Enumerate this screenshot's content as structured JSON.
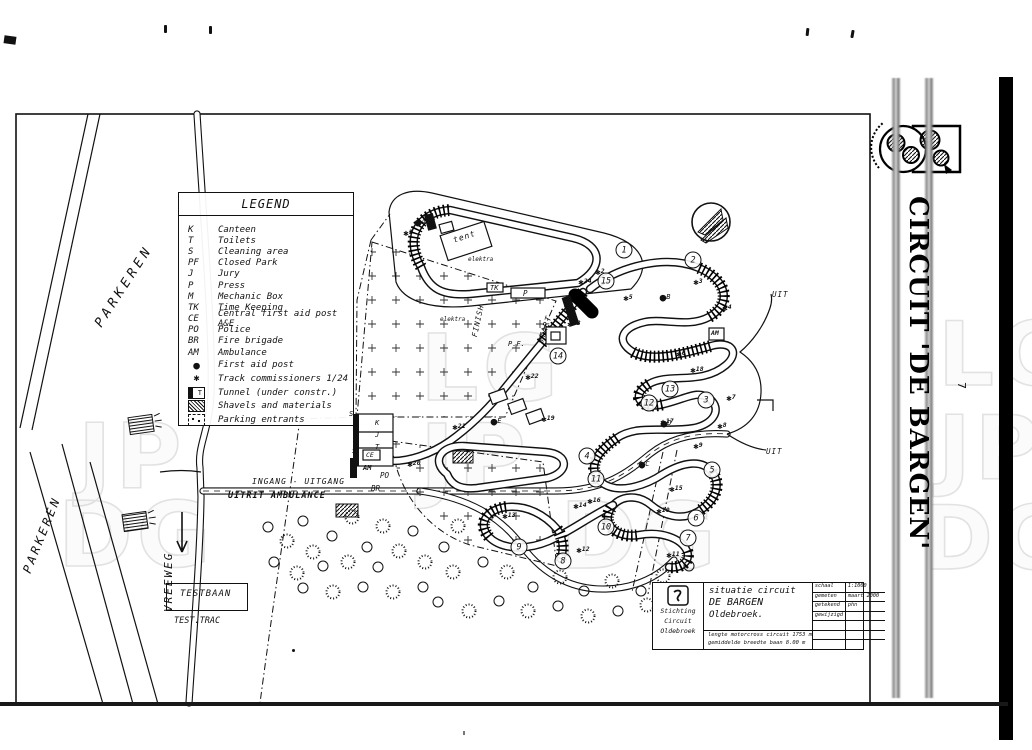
{
  "page": {
    "number": "7",
    "side_title": "CIRCUIT 'DE BARGEN'"
  },
  "legend": {
    "title": "LEGEND",
    "abbrev_items": [
      {
        "key": "K",
        "label": "Canteen"
      },
      {
        "key": "T",
        "label": "Toilets"
      },
      {
        "key": "S",
        "label": "Cleaning area"
      },
      {
        "key": "PF",
        "label": "Closed Park"
      },
      {
        "key": "J",
        "label": "Jury"
      },
      {
        "key": "P",
        "label": "Press"
      },
      {
        "key": "M",
        "label": "Mechanic Box"
      },
      {
        "key": "TK",
        "label": "Time Keeping"
      },
      {
        "key": "CE",
        "label": "Central first aid post A&E"
      },
      {
        "key": "PO",
        "label": "Police"
      },
      {
        "key": "BR",
        "label": "Fire brigade"
      },
      {
        "key": "AM",
        "label": "Ambulance"
      }
    ],
    "symbol_items": [
      {
        "icon": "first-aid-dot",
        "glyph": "●",
        "label": "First aid post"
      },
      {
        "icon": "commissioner-star",
        "glyph": "✱",
        "label": "Track commissioners 1/24"
      },
      {
        "icon": "tunnel-box",
        "glyph": "T",
        "label": "Tunnel (under constr.)"
      },
      {
        "icon": "hatch-box",
        "glyph": "",
        "label": "Shavels and materials"
      },
      {
        "icon": "parking-box",
        "glyph": "",
        "label": "Parking entrants"
      }
    ]
  },
  "map": {
    "labels": [
      {
        "name": "parkeren-upper",
        "t": "PARKEREN",
        "x": 92,
        "y": 322,
        "rot": -57,
        "fs": 13,
        "ls": 4
      },
      {
        "name": "parkeren-lower",
        "t": "PARKEREN",
        "x": 20,
        "y": 570,
        "rot": -68,
        "fs": 12,
        "ls": 3
      },
      {
        "name": "vreeweg",
        "t": "VREEWEG",
        "x": 162,
        "y": 612,
        "rot": -90,
        "fs": 11,
        "ls": 2
      },
      {
        "name": "ingang-uitgang",
        "t": "INGANG - UITGANG",
        "x": 252,
        "y": 477,
        "rot": 0,
        "fs": 8,
        "ls": 1
      },
      {
        "name": "uitrit-ambulance",
        "t": "UITRIT AMBULANCE",
        "x": 228,
        "y": 491,
        "rot": 0,
        "fs": 8.5,
        "ls": 1,
        "fw": 700
      },
      {
        "name": "testbaan",
        "t": "TESTBAAN",
        "x": 180,
        "y": 589,
        "rot": 0,
        "fs": 9,
        "ls": 1
      },
      {
        "name": "test-trac",
        "t": "TEST.TRAC",
        "x": 174,
        "y": 616,
        "rot": 0,
        "fs": 8.5,
        "ls": 0
      },
      {
        "name": "tent",
        "t": "tent",
        "x": 452,
        "y": 236,
        "rot": -18,
        "fs": 8,
        "ls": 1
      },
      {
        "name": "elektra-1",
        "t": "elektra",
        "x": 468,
        "y": 256,
        "rot": 0,
        "fs": 6,
        "ls": 0
      },
      {
        "name": "elektra-2",
        "t": "elektra",
        "x": 440,
        "y": 316,
        "rot": 0,
        "fs": 6,
        "ls": 0
      },
      {
        "name": "tk",
        "t": "TK",
        "x": 490,
        "y": 284,
        "rot": 0,
        "fs": 7,
        "ls": 0
      },
      {
        "name": "p",
        "t": "P",
        "x": 523,
        "y": 289,
        "rot": 0,
        "fs": 7.5,
        "ls": 0
      },
      {
        "name": "finish",
        "t": "FINISH",
        "x": 470,
        "y": 336,
        "rot": -78,
        "fs": 7.5,
        "ls": 1
      },
      {
        "name": "start",
        "t": "START",
        "x": 536,
        "y": 342,
        "rot": -72,
        "fs": 8,
        "ls": 1
      },
      {
        "name": "pf",
        "t": "P.F.",
        "x": 508,
        "y": 340,
        "rot": 0,
        "fs": 7,
        "ls": 0
      },
      {
        "name": "bld-k",
        "t": "K",
        "x": 375,
        "y": 419,
        "rot": 0,
        "fs": 7,
        "ls": 0
      },
      {
        "name": "bld-j",
        "t": "J",
        "x": 375,
        "y": 431,
        "rot": 0,
        "fs": 7,
        "ls": 0
      },
      {
        "name": "bld-t",
        "t": "T",
        "x": 375,
        "y": 443,
        "rot": 0,
        "fs": 7,
        "ls": 0
      },
      {
        "name": "s-1",
        "t": "S",
        "x": 349,
        "y": 410,
        "rot": 0,
        "fs": 7,
        "ls": 0
      },
      {
        "name": "s-2",
        "t": "S",
        "x": 352,
        "y": 447,
        "rot": 0,
        "fs": 7,
        "ls": 0
      },
      {
        "name": "ce",
        "t": "CE",
        "x": 366,
        "y": 451,
        "rot": 0,
        "fs": 6.5,
        "ls": 0
      },
      {
        "name": "am-1",
        "t": "AM",
        "x": 363,
        "y": 464,
        "rot": 0,
        "fs": 7,
        "ls": 0,
        "fw": 700
      },
      {
        "name": "po",
        "t": "PO",
        "x": 380,
        "y": 471,
        "rot": 0,
        "fs": 7.5,
        "ls": 0
      },
      {
        "name": "br",
        "t": "BR",
        "x": 371,
        "y": 484,
        "rot": 0,
        "fs": 7.5,
        "ls": 0
      },
      {
        "name": "am-2",
        "t": "AM",
        "x": 711,
        "y": 329,
        "rot": 0,
        "fs": 6.5,
        "ls": 0,
        "fw": 700
      },
      {
        "name": "uit-1",
        "t": "UIT",
        "x": 772,
        "y": 290,
        "rot": 0,
        "fs": 7.5,
        "ls": 1
      },
      {
        "name": "uit-2",
        "t": "UIT",
        "x": 766,
        "y": 447,
        "rot": 0,
        "fs": 7.5,
        "ls": 1
      }
    ],
    "corners": [
      {
        "n": "1",
        "x": 624,
        "y": 250
      },
      {
        "n": "2",
        "x": 693,
        "y": 260
      },
      {
        "n": "3",
        "x": 706,
        "y": 400
      },
      {
        "n": "4",
        "x": 587,
        "y": 456
      },
      {
        "n": "5",
        "x": 712,
        "y": 470
      },
      {
        "n": "6",
        "x": 696,
        "y": 518
      },
      {
        "n": "7",
        "x": 688,
        "y": 538
      },
      {
        "n": "8",
        "x": 563,
        "y": 561
      },
      {
        "n": "9",
        "x": 519,
        "y": 547
      },
      {
        "n": "10",
        "x": 606,
        "y": 527
      },
      {
        "n": "11",
        "x": 596,
        "y": 479
      },
      {
        "n": "12",
        "x": 649,
        "y": 403
      },
      {
        "n": "13",
        "x": 670,
        "y": 389
      },
      {
        "n": "14",
        "x": 558,
        "y": 356
      },
      {
        "n": "15",
        "x": 606,
        "y": 281
      }
    ],
    "commissioners": [
      {
        "n": "1",
        "x": 408,
        "y": 231
      },
      {
        "n": "2",
        "x": 600,
        "y": 270
      },
      {
        "n": "3",
        "x": 698,
        "y": 280
      },
      {
        "n": "4",
        "x": 727,
        "y": 306
      },
      {
        "n": "5",
        "x": 628,
        "y": 296
      },
      {
        "n": "6",
        "x": 681,
        "y": 352
      },
      {
        "n": "7",
        "x": 731,
        "y": 396
      },
      {
        "n": "8",
        "x": 722,
        "y": 424
      },
      {
        "n": "9",
        "x": 698,
        "y": 444
      },
      {
        "n": "10",
        "x": 663,
        "y": 509
      },
      {
        "n": "11",
        "x": 673,
        "y": 553
      },
      {
        "n": "12",
        "x": 583,
        "y": 548
      },
      {
        "n": "13",
        "x": 509,
        "y": 514
      },
      {
        "n": "14",
        "x": 580,
        "y": 504
      },
      {
        "n": "15",
        "x": 676,
        "y": 487
      },
      {
        "n": "16",
        "x": 594,
        "y": 499
      },
      {
        "n": "17",
        "x": 667,
        "y": 420
      },
      {
        "n": "18",
        "x": 697,
        "y": 368
      },
      {
        "n": "19",
        "x": 548,
        "y": 417
      },
      {
        "n": "20",
        "x": 414,
        "y": 462
      },
      {
        "n": "21",
        "x": 459,
        "y": 425
      },
      {
        "n": "22",
        "x": 532,
        "y": 375
      },
      {
        "n": "23",
        "x": 574,
        "y": 322
      },
      {
        "n": "24",
        "x": 585,
        "y": 280
      }
    ],
    "first_aid": [
      {
        "l": "A",
        "x": 420,
        "y": 221
      },
      {
        "l": "B",
        "x": 665,
        "y": 296
      },
      {
        "l": "C",
        "x": 644,
        "y": 463
      },
      {
        "l": "D",
        "x": 666,
        "y": 422
      },
      {
        "l": "E",
        "x": 496,
        "y": 420
      }
    ]
  },
  "title_block": {
    "org_lines": [
      "Stichting",
      "Circuit",
      "Oldebroek"
    ],
    "subject_lines": [
      "situatie circuit",
      "DE BARGEN",
      "Oldebroek."
    ],
    "spec_lines": [
      "lengte motorcross circuit 1753 m",
      "gemiddelde breedte baan 8.00 m"
    ],
    "meta_rows": [
      {
        "k": "schaal",
        "v": "1:1000"
      },
      {
        "k": "gemeten",
        "v": "maart 2000"
      },
      {
        "k": "getekend",
        "v": "phn"
      },
      {
        "k": "gewijzigd",
        "v": ""
      },
      {
        "k": "",
        "v": ""
      },
      {
        "k": "",
        "v": ""
      },
      {
        "k": "",
        "v": ""
      }
    ]
  },
  "watermarks": [
    {
      "t": "LG",
      "x": 420,
      "y": 330,
      "fs": 92
    },
    {
      "t": "JP",
      "x": 420,
      "y": 420,
      "fs": 92
    },
    {
      "t": "DG",
      "x": 560,
      "y": 498,
      "fs": 92
    },
    {
      "t": "JP",
      "x": 78,
      "y": 420,
      "fs": 90
    },
    {
      "t": "DG",
      "x": 58,
      "y": 498,
      "fs": 90
    },
    {
      "t": "LG",
      "x": 938,
      "y": 318,
      "fs": 88
    },
    {
      "t": "JP",
      "x": 938,
      "y": 412,
      "fs": 88
    },
    {
      "t": "DG",
      "x": 920,
      "y": 502,
      "fs": 88
    }
  ]
}
